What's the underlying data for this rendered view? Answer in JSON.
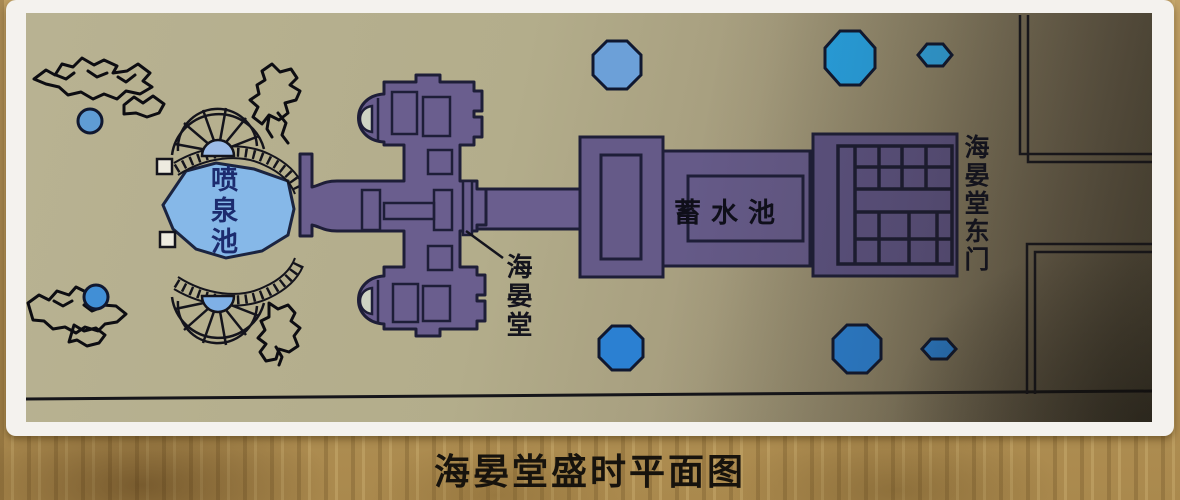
{
  "map_photo": {
    "caption": "海晏堂盛时平面图",
    "labels": {
      "fountain_pool": "喷泉池",
      "hall": "海晏堂",
      "reservoir": "蓄水池",
      "east_gate": "海晏堂东门"
    },
    "colors": {
      "map_paper": "#b2ac8a",
      "building_purple": "#6a5e8e",
      "fountain_pool_blue": "#86b8e8",
      "pond_blue_bright": "#2aa2e0",
      "pond_blue_deep": "#2b80d2",
      "ink_outline": "#16161f",
      "photo_border": "#f4f2ee",
      "wood_background": "#b5945c"
    }
  }
}
